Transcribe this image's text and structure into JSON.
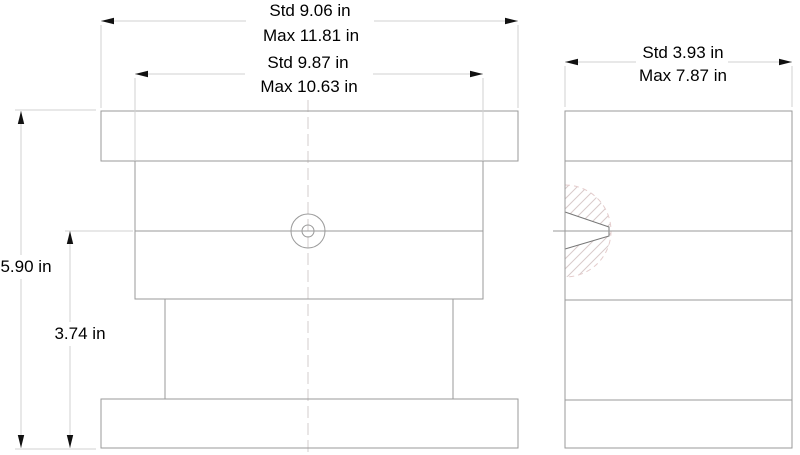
{
  "drawing": {
    "type": "engineering-dimension-drawing",
    "views": [
      {
        "id": "front",
        "label": "front-view"
      },
      {
        "id": "side",
        "label": "side-view"
      }
    ],
    "dimensions": {
      "front_outer_width": {
        "std": "Std 9.06 in",
        "max": "Max 11.81 in"
      },
      "front_body_width": {
        "std": "Std 9.87 in",
        "max": "Max 10.63 in"
      },
      "side_depth": {
        "std": "Std 3.93 in",
        "max": "Max 7.87 in"
      },
      "overall_height": {
        "value": "5.90 in"
      },
      "lower_height": {
        "value": "3.74 in"
      }
    },
    "colors": {
      "outline": "#9a9a9a",
      "section_edge": "#777777",
      "dimension_line": "#d2d2d2",
      "arrow": "#111111",
      "text": "#000000",
      "centerline": "#e2dede",
      "hatch": "#d8caca",
      "drill_arc": "#e4cccc",
      "background": "#ffffff"
    }
  }
}
